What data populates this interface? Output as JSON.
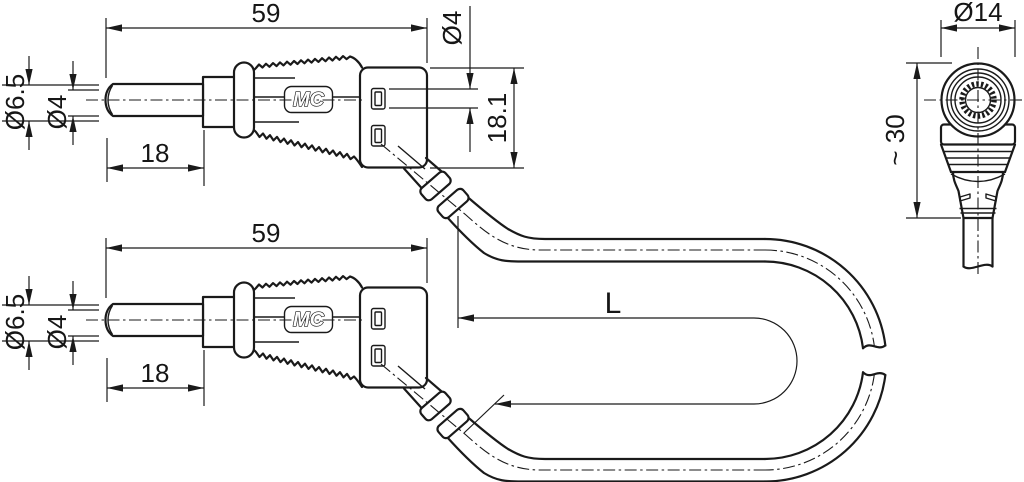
{
  "drawing": {
    "background": "#ffffff",
    "line_color": "#1a1a1a",
    "plug": {
      "overall_length": "59",
      "sleeve_diameter": "Ø6.5",
      "pin_diameter": "Ø4",
      "pin_length": "18",
      "logo": "MC",
      "stacking_socket_diameter": "Ø4",
      "body_width": "18.1"
    },
    "front_view": {
      "head_diameter": "Ø14",
      "height": "~ 30"
    },
    "cable": {
      "length_label": "L"
    }
  }
}
